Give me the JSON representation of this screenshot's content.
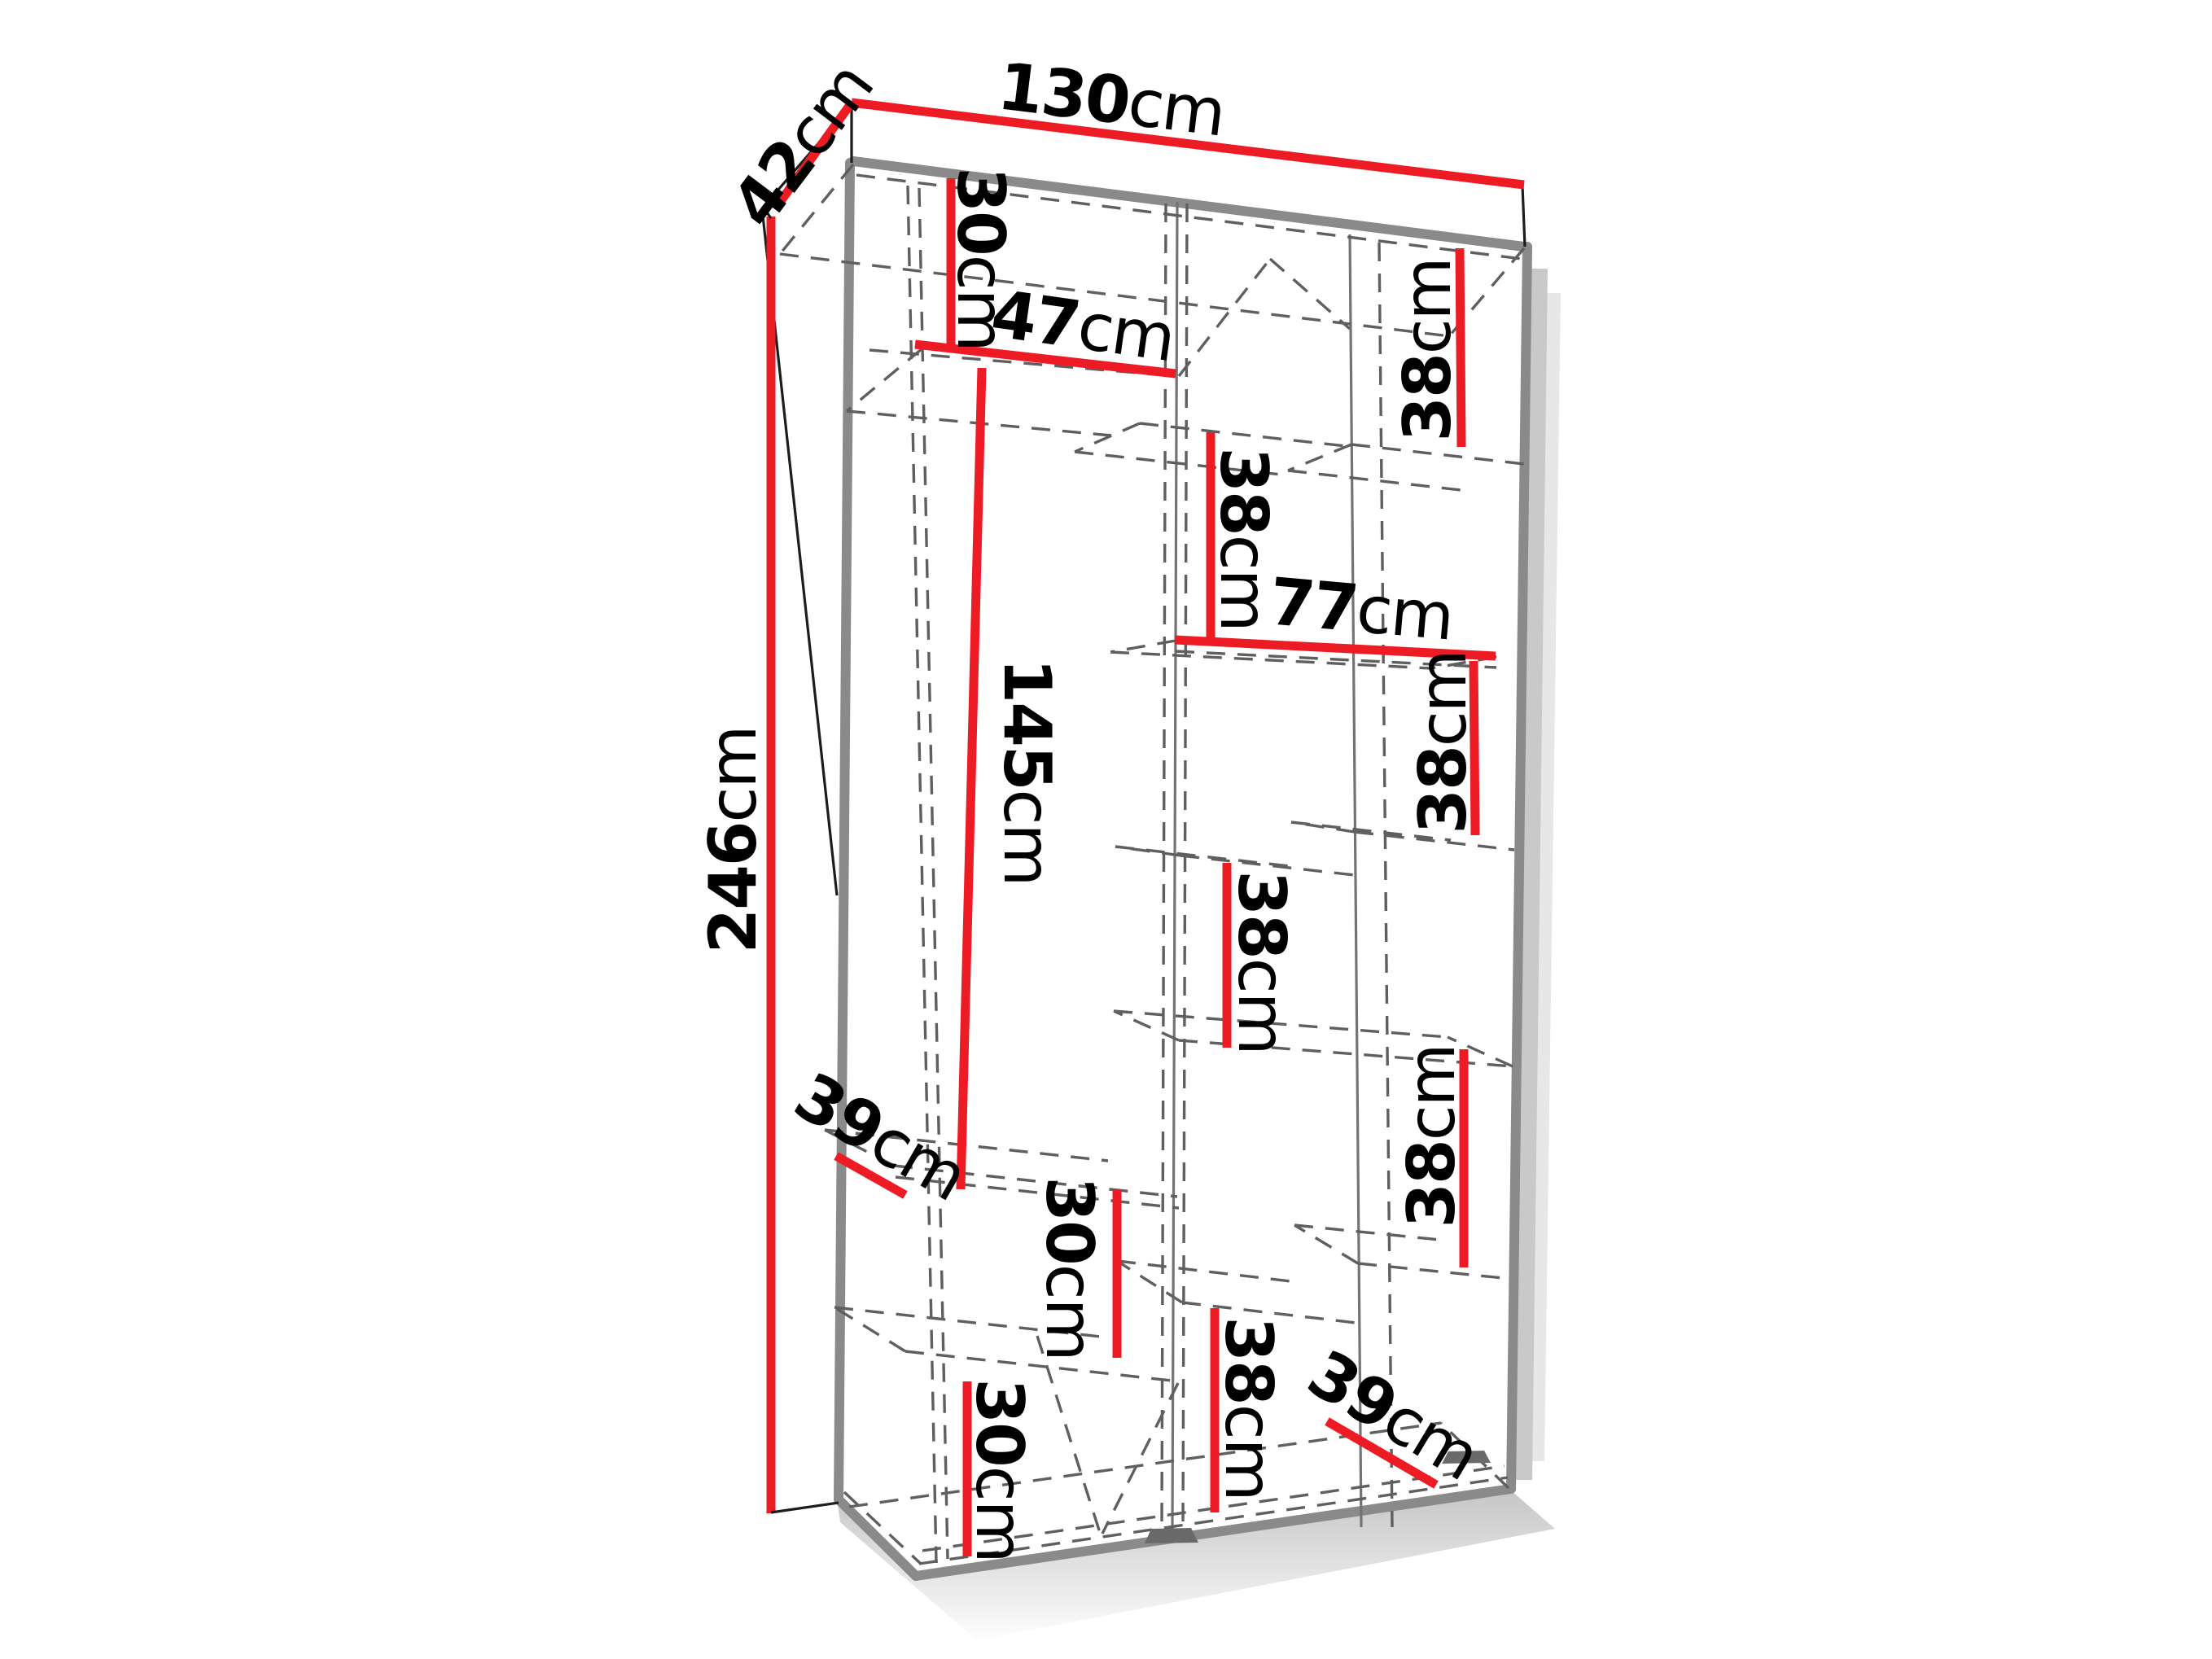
{
  "diagram": {
    "kind": "wardrobe-dimension-diagram",
    "background": "#ffffff",
    "colors": {
      "dimension_line": "#ed1c24",
      "edge": "#8a8a8a",
      "hidden_line": "#5f5f5f",
      "text": "#000000"
    },
    "dims": {
      "width": {
        "value": "130",
        "unit": "cm"
      },
      "depth": {
        "value": "42",
        "unit": "cm"
      },
      "height": {
        "value": "246",
        "unit": "cm"
      },
      "left_top_gap": {
        "value": "30",
        "unit": "cm"
      },
      "left_shelf_width": {
        "value": "47",
        "unit": "cm"
      },
      "left_hanging_height": {
        "value": "145",
        "unit": "cm"
      },
      "mid_upper_gap": {
        "value": "38",
        "unit": "cm"
      },
      "inner_width_right": {
        "value": "77",
        "unit": "cm"
      },
      "right_top_gap": {
        "value": "38",
        "unit": "cm"
      },
      "right_upper_gap": {
        "value": "38",
        "unit": "cm"
      },
      "mid_middle_gap": {
        "value": "38",
        "unit": "cm"
      },
      "right_lower_gap": {
        "value": "38",
        "unit": "cm"
      },
      "left_shelf_depth": {
        "value": "39",
        "unit": "cm"
      },
      "left_middle_gap": {
        "value": "30",
        "unit": "cm"
      },
      "left_lower_gap": {
        "value": "30",
        "unit": "cm"
      },
      "mid_lower_gap": {
        "value": "38",
        "unit": "cm"
      },
      "bottom_shelf_depth": {
        "value": "39",
        "unit": "cm"
      }
    }
  }
}
